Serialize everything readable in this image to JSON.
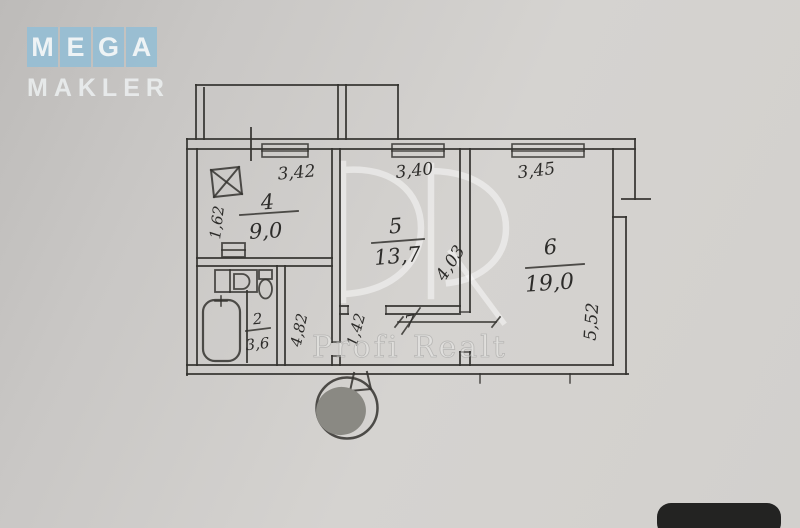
{
  "logo": {
    "letters": [
      "M",
      "E",
      "G",
      "A"
    ],
    "bottom": "MAKLER",
    "tile_color": "#96bed4"
  },
  "watermark": {
    "big_letters": "PR",
    "text": "Profi Realt"
  },
  "plan": {
    "rooms": [
      {
        "number": "4",
        "area": "9,0",
        "top_dim": "3,42",
        "side_dim": "1,62"
      },
      {
        "number": "5",
        "area": "13,7",
        "top_dim": "3,40",
        "side_dim": "4,03"
      },
      {
        "number": "6",
        "area": "19,0",
        "top_dim": "3,45",
        "side_dim": "5,52"
      },
      {
        "number": "2",
        "area": "3,6"
      },
      {
        "number": "7"
      }
    ],
    "hall_dims": {
      "length": "4,82",
      "opening": "1,42"
    }
  },
  "icons": {
    "bathtub": "rounded-rect outline",
    "toilet": "tank+bowl outline",
    "sink_counter": "rect with D shape",
    "vent_shaft": "square with X",
    "stamp": "gray filled circle"
  },
  "colors": {
    "paper": "#d2d0cd",
    "ink": "#34332f",
    "stamp_gray": "#8a8983",
    "logo_tile": "#96bed4"
  }
}
